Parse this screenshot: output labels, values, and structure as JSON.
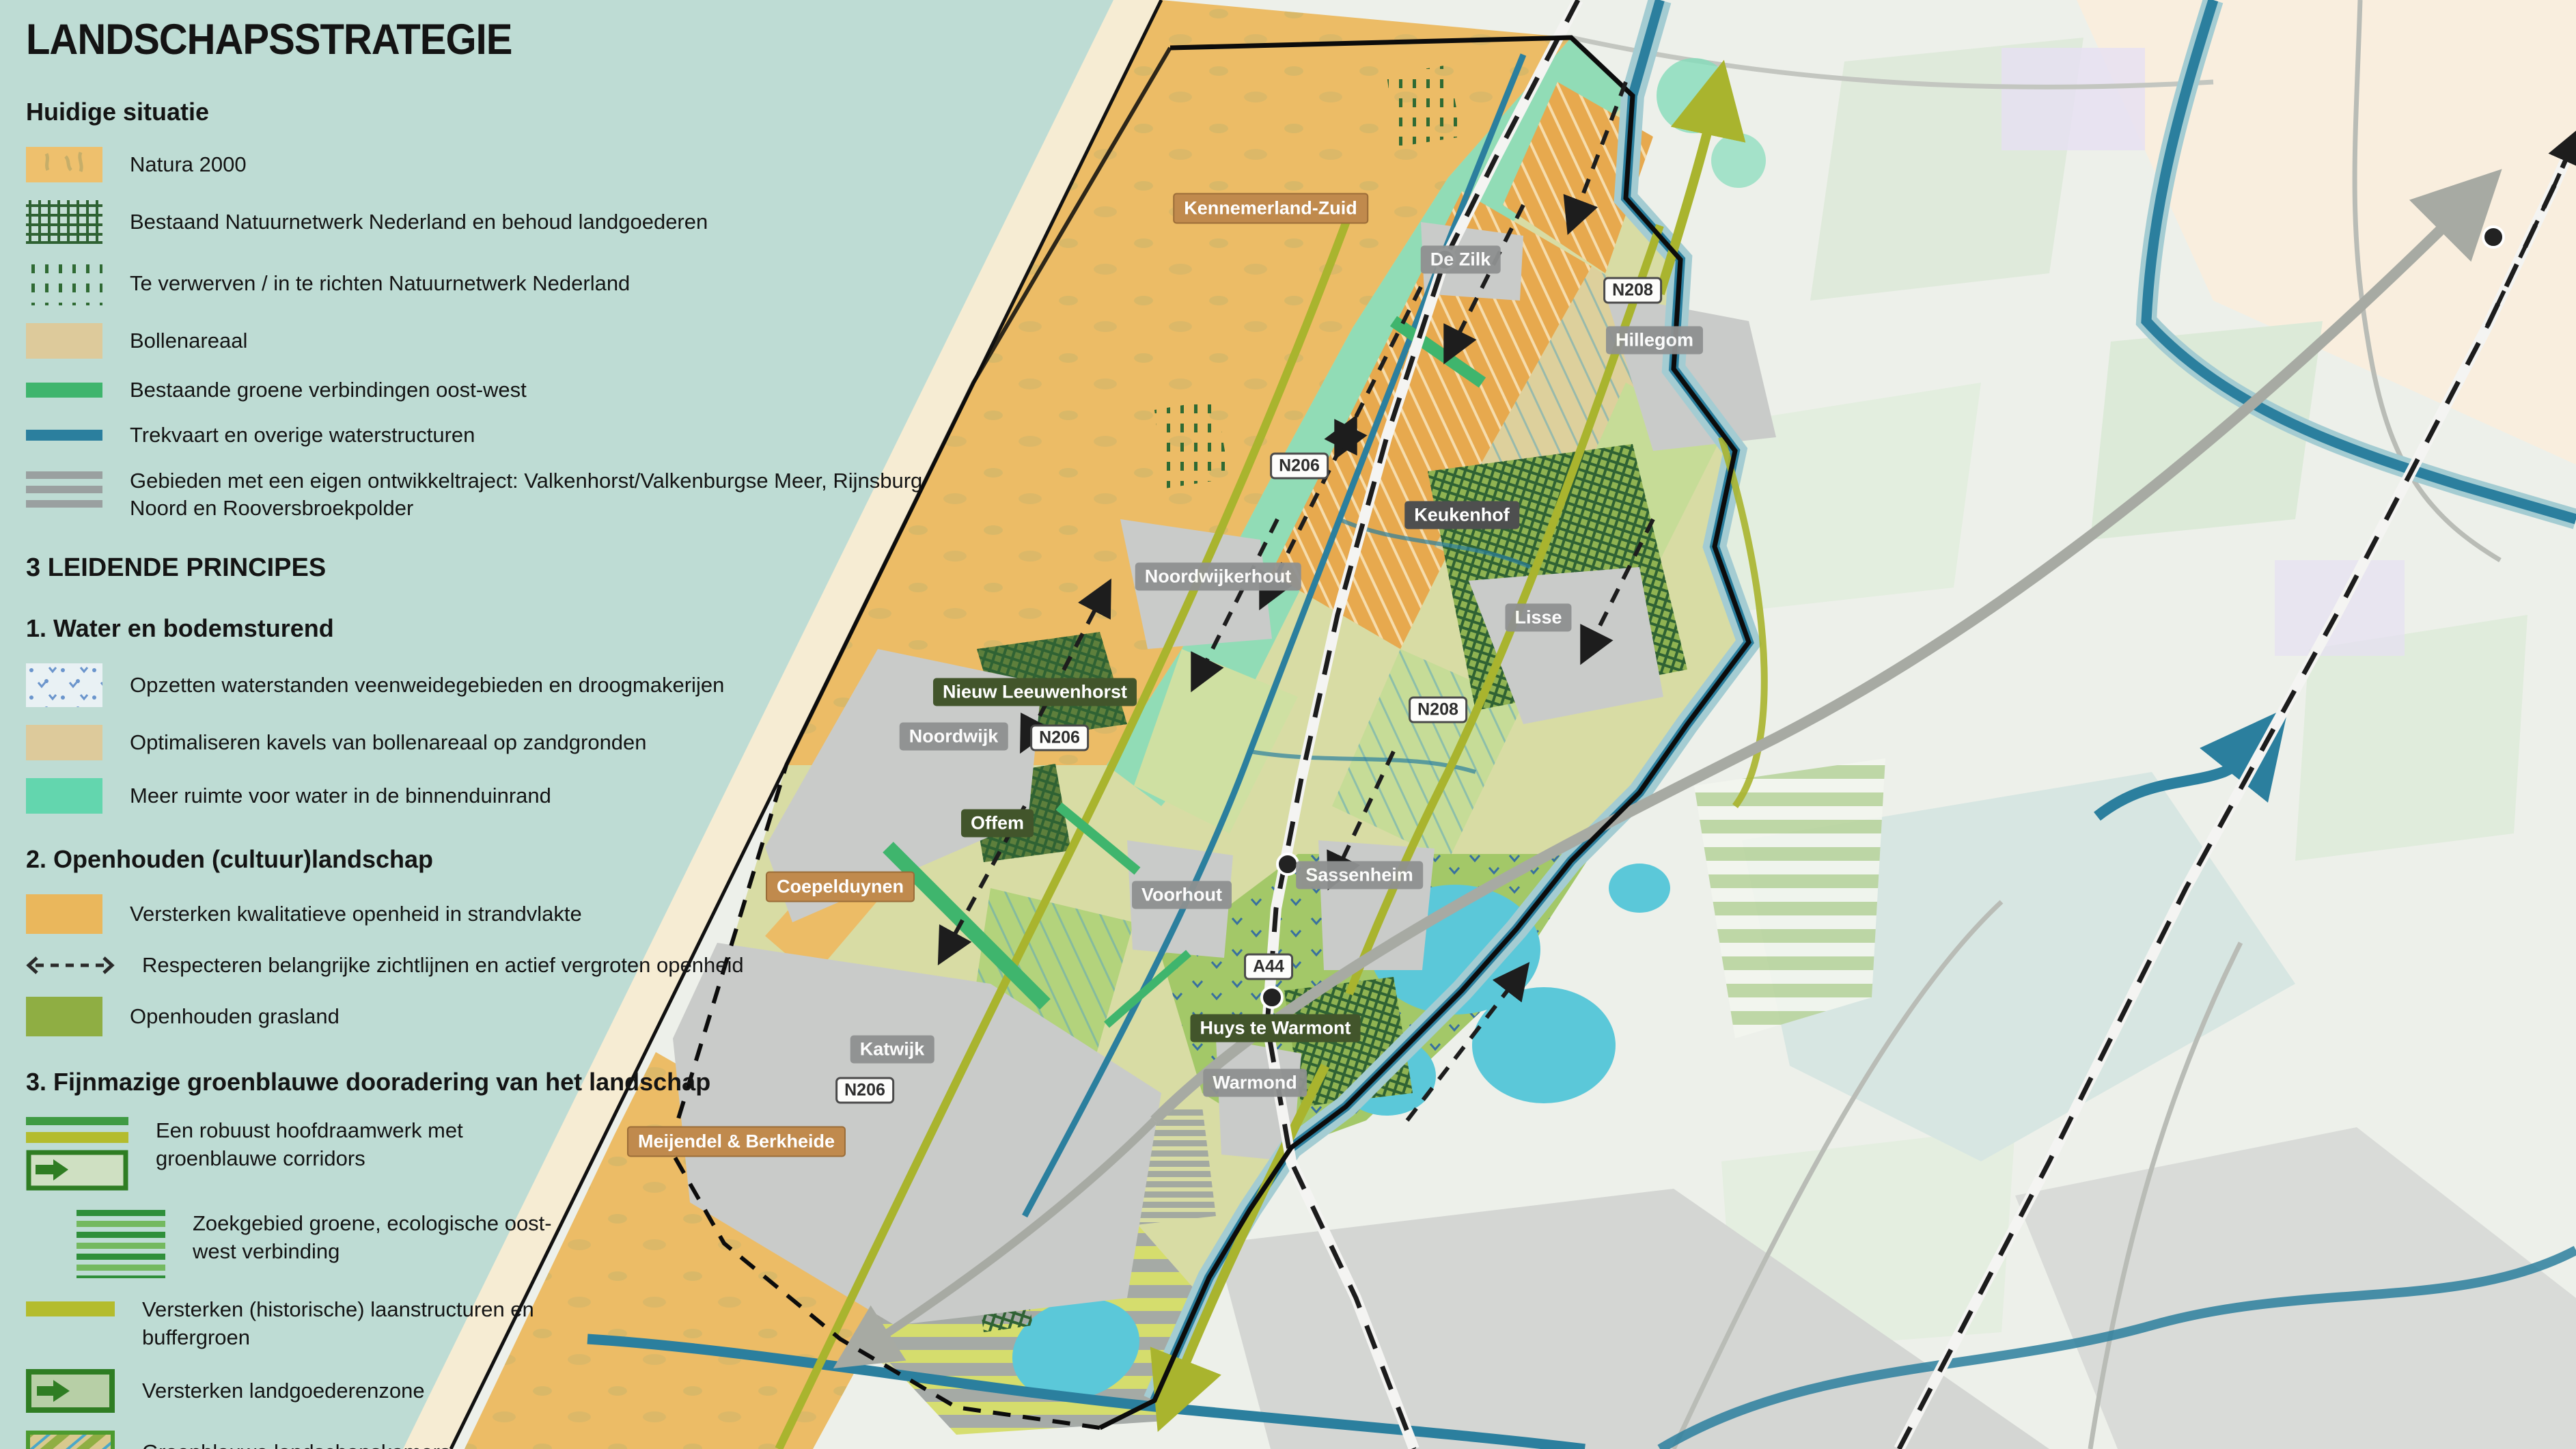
{
  "legend": {
    "title": "LANDSCHAPSSTRATEGIE",
    "current": {
      "heading": "Huidige situatie",
      "items": [
        {
          "icon": "natura2000-swatch",
          "label": "Natura 2000"
        },
        {
          "icon": "crosshatch-green-swatch",
          "label": "Bestaand Natuurnetwerk Nederland en behoud landgoederen"
        },
        {
          "icon": "dashed-green-swatch",
          "label": "Te verwerven / in te richten Natuurnetwerk Nederland"
        },
        {
          "icon": "tan-swatch",
          "label": "Bollenareaal"
        },
        {
          "icon": "green-bar-swatch",
          "label": "Bestaande groene verbindingen oost-west"
        },
        {
          "icon": "teal-bar-swatch",
          "label": "Trekvaart en overige waterstructuren"
        },
        {
          "icon": "grey-stripes-swatch",
          "label": "Gebieden met een eigen ontwikkeltraject: Valkenhorst/Valkenburgse Meer, Rijnsburg Noord en Rooversbroekpolder"
        }
      ]
    },
    "principles_heading": "3 LEIDENDE PRINCIPES",
    "p1": {
      "heading": "1.  Water en bodemsturend",
      "items": [
        {
          "icon": "blue-dots-swatch",
          "label": "Opzetten waterstanden veenweidegebieden en droogmakerijen"
        },
        {
          "icon": "tan-swatch",
          "label": "Optimaliseren kavels van bollenareaal op zandgronden"
        },
        {
          "icon": "mint-swatch",
          "label": "Meer ruimte voor water in de binnenduinrand"
        }
      ]
    },
    "p2": {
      "heading": "2.  Openhouden (cultuur)landschap",
      "items": [
        {
          "icon": "orange-swatch",
          "label": "Versterken kwalitatieve openheid in strandvlakte"
        },
        {
          "icon": "dashed-arrow-icon",
          "label": "Respecteren belangrijke zichtlijnen en actief vergroten openheid"
        },
        {
          "icon": "olive-green-swatch",
          "label": "Openhouden grasland"
        }
      ]
    },
    "p3": {
      "heading": "3.  Fijnmazige groenblauwe dooradering van het landschap",
      "items": [
        {
          "icon": "framework-corridor-icon",
          "label": "Een robuust hoofdraamwerk met groenblauwe corridors"
        },
        {
          "icon": "green-stripes-swatch",
          "label": "Zoekgebied groene, ecologische oost-west verbinding"
        },
        {
          "icon": "olive-bar-swatch",
          "label": "Versterken (historische) laanstructuren en buffergroen"
        },
        {
          "icon": "arrow-box-icon",
          "label": "Versterken landgoederenzone"
        },
        {
          "icon": "landscape-rooms-swatch",
          "label": "Groenblauwe landschapskamers"
        }
      ]
    }
  },
  "map": {
    "labels": [
      {
        "text": "Kennemerland-Zuid",
        "kind": "natura"
      },
      {
        "text": "De Zilk",
        "kind": "town"
      },
      {
        "text": "N208",
        "kind": "road"
      },
      {
        "text": "Hillegom",
        "kind": "town"
      },
      {
        "text": "N206",
        "kind": "road"
      },
      {
        "text": "Keukenhof",
        "kind": "town-dark"
      },
      {
        "text": "Noordwijkerhout",
        "kind": "town"
      },
      {
        "text": "Lisse",
        "kind": "town"
      },
      {
        "text": "Nieuw Leeuwenhorst",
        "kind": "estate"
      },
      {
        "text": "Noordwijk",
        "kind": "town"
      },
      {
        "text": "N206",
        "kind": "road"
      },
      {
        "text": "N208",
        "kind": "road"
      },
      {
        "text": "Offem",
        "kind": "estate"
      },
      {
        "text": "Coepelduynen",
        "kind": "natura"
      },
      {
        "text": "Voorhout",
        "kind": "town"
      },
      {
        "text": "Sassenheim",
        "kind": "town"
      },
      {
        "text": "A44",
        "kind": "road"
      },
      {
        "text": "Huys te Warmont",
        "kind": "estate"
      },
      {
        "text": "Katwijk",
        "kind": "town"
      },
      {
        "text": "Warmond",
        "kind": "town"
      },
      {
        "text": "N206",
        "kind": "road"
      },
      {
        "text": "Meijendel & Berkheide",
        "kind": "natura"
      }
    ],
    "colors": {
      "sea_background": "#bedcd4",
      "land": "#edf0ea",
      "beach": "#f6ecd3",
      "dune_orange": "#ecbc66",
      "bulb_field_orange": "#e7a94e",
      "bollenareaal_tan": "#ddca9b",
      "binnenduinrand_mint": "#85dcba",
      "grasland_olive": "#8fae43",
      "green_connection": "#3fb56d",
      "water_teal": "#2b7f9e",
      "lake_cyan": "#5bc8d9",
      "urban_grey": "#c9cbc9",
      "road_olive": "#a9b42e",
      "railway_black": "#1c1c1c",
      "natura_label": "#c08a4d",
      "estate_label": "#42552b",
      "town_label": "#8f9191",
      "dark_green_pattern": "#2f6233"
    }
  }
}
